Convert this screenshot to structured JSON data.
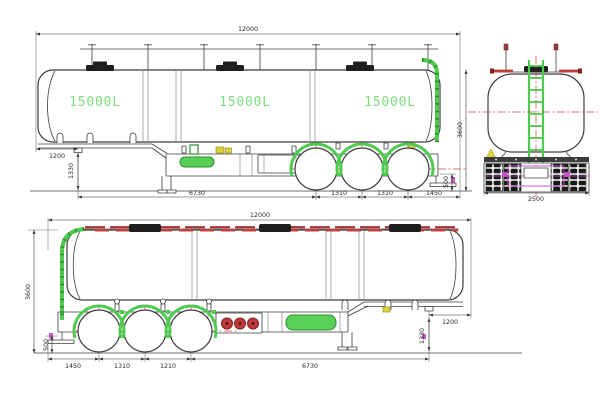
{
  "drawing_title": "fuel-tank-semi-trailer-three-view-drawing",
  "colors": {
    "line": "#3c3c3c",
    "green_fitting": "#4ecb4e",
    "compartment_label_green": "#7edd7e",
    "centerline_red": "#c24545",
    "walkway_red": "#c24040",
    "axle_magenta": "#c853c8",
    "accessory_yellow": "#ddd23a"
  },
  "side_view_top": {
    "overall_length": "12000",
    "overall_height": "3600",
    "compartment_labels": [
      "15000L",
      "15000L",
      "15000L"
    ],
    "front_overhang": "1200",
    "kingpin_height": "1330",
    "kingpin_to_first_axle": "6730",
    "axle_spacing_1": "1310",
    "axle_spacing_2": "1310",
    "rear_overhang": "1450",
    "rear_clearance": "500"
  },
  "rear_view": {
    "overall_width": "2500"
  },
  "side_view_bottom": {
    "overall_length": "12000",
    "overall_height": "3600",
    "rear_overhang": "1450",
    "axle_spacing_1": "1310",
    "axle_spacing_2": "1210",
    "first_axle_to_kingpin": "6730",
    "front_overhang": "1200",
    "kingpin_height": "1330",
    "rear_clearance": "500"
  }
}
